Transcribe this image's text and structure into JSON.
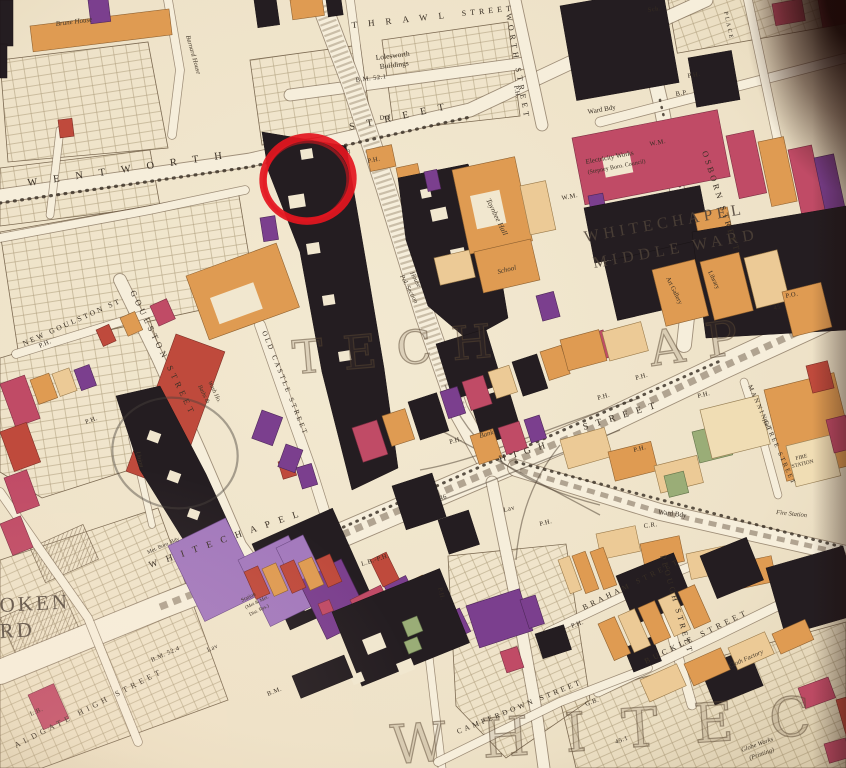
{
  "map": {
    "type": "historic poverty map (hand-coloured, photographed)",
    "area": "Whitechapel / Aldgate, London",
    "streets": {
      "thrawl_a": "THRAWL",
      "thrawl_b": "STREET",
      "worth": "WORTH STREET",
      "wentworth_a": "WENTWORTH",
      "wentworth_b": "STREET",
      "osborn": "OSBORN STREET",
      "goulston": "GOULSTON STREET",
      "new_goulston": "NEW GOULSTON ST",
      "old_castle": "OLD CASTLE STREET",
      "whitechapel_high_a": "WHITECHAPEL",
      "whitechapel_high_b": "HIGH",
      "whitechapel_high_c": "STREET",
      "aldgate_high": "ALDGATE HIGH STREET",
      "plough": "PLOUGH STREET",
      "buckle": "BUCKLE STREET",
      "braham": "BRAHAM STREET",
      "camperdown": "CAMPERDOWN STREET",
      "manningtree": "MANNINGTREE STREET",
      "place_fragment": "PLACE"
    },
    "districts": {
      "portsoken_a": "OKEN",
      "portsoken_b": "RD",
      "middle_ward_a": "WHITECHAPEL",
      "middle_ward_b": "MIDDLE WARD",
      "ghost_mid_a": "TECH",
      "ghost_mid_b": "AP",
      "ghost_bottom": "WHITEC"
    },
    "places": {
      "lolesworth_a": "Lolesworth",
      "lolesworth_b": "Buildings",
      "toynbee": "Toynbee Hall",
      "brune": "Brune House",
      "barnard": "Barnard House",
      "works_a": "Electricity Works",
      "works_b": "(Stepney Boro. Council)",
      "art_gallery": "Art Gallery",
      "library": "Library",
      "school": "School",
      "police_a": "Pol. Section",
      "police_b": "House",
      "bank": "Bank",
      "hall": "Hall",
      "fire_station_a": "FIRE",
      "fire_station_b": "STATION",
      "fire_station_road": "Fire Station",
      "baths_a": "Baths &",
      "baths_b": "Wash Ho.",
      "station_a": "Station",
      "station_b": "(Met & Met.",
      "station_c": "Dist. Rys.)",
      "globe_a": "Globe Works",
      "globe_b": "(Printing)",
      "cloth_factory": "Cloth Factory",
      "union": "Union",
      "ward_bdy": "Ward Bdy",
      "met_boro_bdy": "Met. Boro. Bdy"
    },
    "markers": [
      {
        "t": "P.H.",
        "x": 368,
        "y": 163,
        "r": -12
      },
      {
        "t": "P.H.",
        "x": 514,
        "y": 86,
        "r": 78
      },
      {
        "t": "P.H.",
        "x": 688,
        "y": 78,
        "r": -10
      },
      {
        "t": "B.P.",
        "x": 676,
        "y": 96,
        "r": -10
      },
      {
        "t": "Sch.",
        "x": 648,
        "y": 12,
        "r": -8
      },
      {
        "t": "W.M.",
        "x": 562,
        "y": 200,
        "r": -11
      },
      {
        "t": "W.M.",
        "x": 650,
        "y": 146,
        "r": -11
      },
      {
        "t": "P.O.",
        "x": 786,
        "y": 298,
        "r": -12
      },
      {
        "t": "45",
        "x": 774,
        "y": 310,
        "r": -12
      },
      {
        "t": "39.8",
        "x": 338,
        "y": 156,
        "r": -12
      },
      {
        "t": "Def",
        "x": 380,
        "y": 120,
        "r": -8
      },
      {
        "t": "B.M. 52.1",
        "x": 356,
        "y": 82,
        "r": -7
      },
      {
        "t": "P.H.",
        "x": 86,
        "y": 424,
        "r": -20
      },
      {
        "t": "P.H.",
        "x": 40,
        "y": 348,
        "r": -24
      },
      {
        "t": "P.H.",
        "x": 450,
        "y": 444,
        "r": -16
      },
      {
        "t": "P.H.",
        "x": 540,
        "y": 526,
        "r": -14
      },
      {
        "t": "P.H.",
        "x": 634,
        "y": 452,
        "r": -14
      },
      {
        "t": "P.H.",
        "x": 636,
        "y": 380,
        "r": -16
      },
      {
        "t": "P.H.",
        "x": 598,
        "y": 400,
        "r": -16
      },
      {
        "t": "P.H.",
        "x": 698,
        "y": 398,
        "r": -14
      },
      {
        "t": "C.R.",
        "x": 644,
        "y": 528,
        "r": -8
      },
      {
        "t": "46",
        "x": 440,
        "y": 500,
        "r": -16
      },
      {
        "t": "B.M. 52.4",
        "x": 152,
        "y": 662,
        "r": -24
      },
      {
        "t": "Lav",
        "x": 208,
        "y": 652,
        "r": -24
      },
      {
        "t": "Lav",
        "x": 504,
        "y": 512,
        "r": -14
      },
      {
        "t": "L.B.",
        "x": 31,
        "y": 716,
        "r": -24
      },
      {
        "t": "G.B.",
        "x": 586,
        "y": 706,
        "r": -20
      },
      {
        "t": "45.1",
        "x": 616,
        "y": 744,
        "r": -20
      },
      {
        "t": "L.B.-P.H.",
        "x": 362,
        "y": 566,
        "r": -18
      },
      {
        "t": "P.H.",
        "x": 572,
        "y": 628,
        "r": -20
      },
      {
        "t": "P.H.",
        "x": 438,
        "y": 588,
        "r": 76
      },
      {
        "t": "B.M.",
        "x": 268,
        "y": 696,
        "r": -22
      }
    ],
    "annotations": {
      "highlight_circle_color": "#e4161f",
      "pencil_circle_color": "#4a423c"
    },
    "palette": {
      "parchment": "#efe3c9",
      "road": "#f6eedb",
      "ink": "#3a3025",
      "black_class": "#241d21",
      "purple_class": "#7b3f8e",
      "lilac_class": "#a379bd",
      "magenta_class": "#c04b66",
      "red_class": "#bf4a3c",
      "orange_class": "#df9b52",
      "tan_class": "#ecca96",
      "green_space": "#9aad77"
    }
  }
}
